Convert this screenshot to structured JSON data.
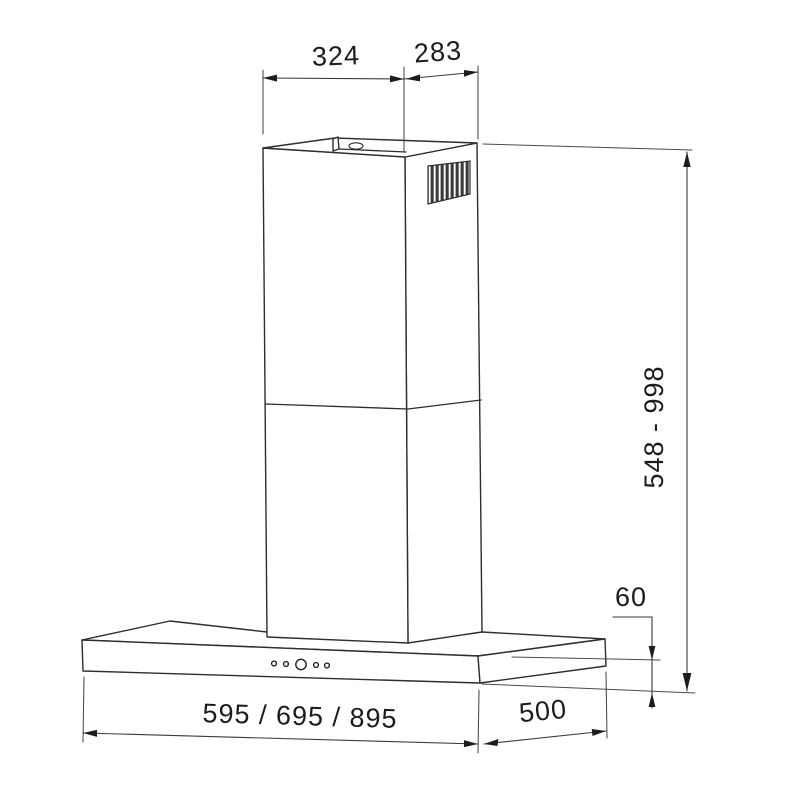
{
  "drawing": {
    "subject": "wall-mounted chimney cooker hood dimension drawing",
    "background": "#ffffff",
    "line_color": "#2e2e2e",
    "text_color": "#1c1c1c",
    "labels": {
      "chimney_front_width": "324",
      "chimney_side_depth": "283",
      "chimney_height_range": "548 - 998",
      "canopy_height": "60",
      "canopy_widths": "595 / 695 / 895",
      "canopy_depth": "500"
    }
  }
}
